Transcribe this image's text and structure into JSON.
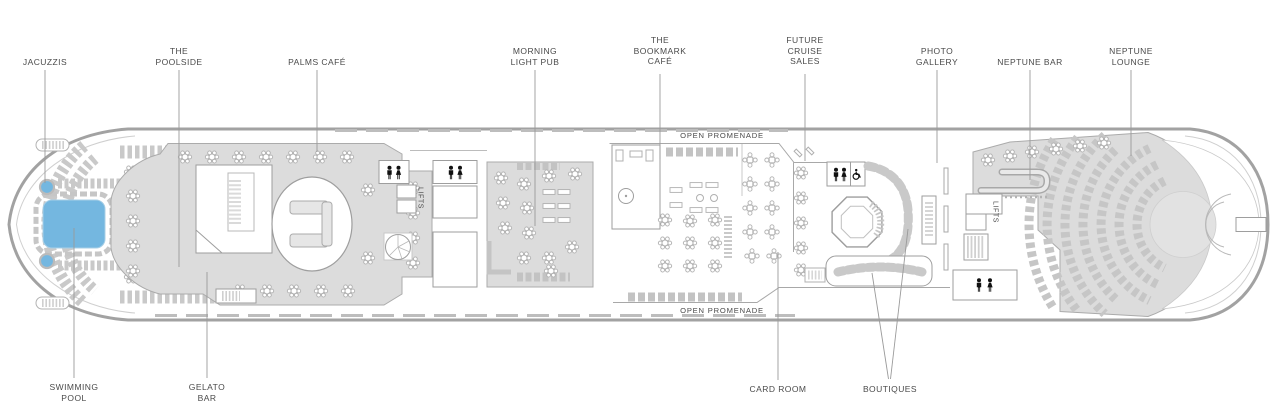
{
  "page": {
    "type": "cruise-ship-deck-plan"
  },
  "colors": {
    "pool_blue": "#74b7e0",
    "deck_gray": "#dcdcdc",
    "hull_outline": "#a2a2a2",
    "furniture_gray": "#b0b0b0",
    "label_text": "#4a4a4a",
    "icon_black": "#111111"
  },
  "icons": [
    "male-icon",
    "female-icon",
    "wheelchair-icon"
  ],
  "labels": {
    "top": [
      {
        "id": "jacuzzis",
        "text": "JACUZZIS"
      },
      {
        "id": "the-poolside",
        "text": "THE\nPOOLSIDE"
      },
      {
        "id": "palms-cafe",
        "text": "PALMS CAFÉ"
      },
      {
        "id": "morning-light-pub",
        "text": "MORNING\nLIGHT PUB"
      },
      {
        "id": "the-bookmark-cafe",
        "text": "THE\nBOOKMARK\nCAFÉ"
      },
      {
        "id": "future-cruise-sales",
        "text": "FUTURE\nCRUISE\nSALES"
      },
      {
        "id": "photo-gallery",
        "text": "PHOTO\nGALLERY"
      },
      {
        "id": "neptune-bar",
        "text": "NEPTUNE BAR"
      },
      {
        "id": "neptune-lounge",
        "text": "NEPTUNE\nLOUNGE"
      }
    ],
    "bottom": [
      {
        "id": "swimming-pool",
        "text": "SWIMMING\nPOOL"
      },
      {
        "id": "gelato-bar",
        "text": "GELATO\nBAR"
      },
      {
        "id": "card-room",
        "text": "CARD ROOM"
      },
      {
        "id": "boutiques",
        "text": "BOUTIQUES"
      }
    ],
    "deck": {
      "open_promenade_top": "OPEN PROMENADE",
      "open_promenade_bottom": "OPEN PROMENADE",
      "lifts_left": "LIFTS",
      "lifts_right": "LIFTS"
    }
  }
}
